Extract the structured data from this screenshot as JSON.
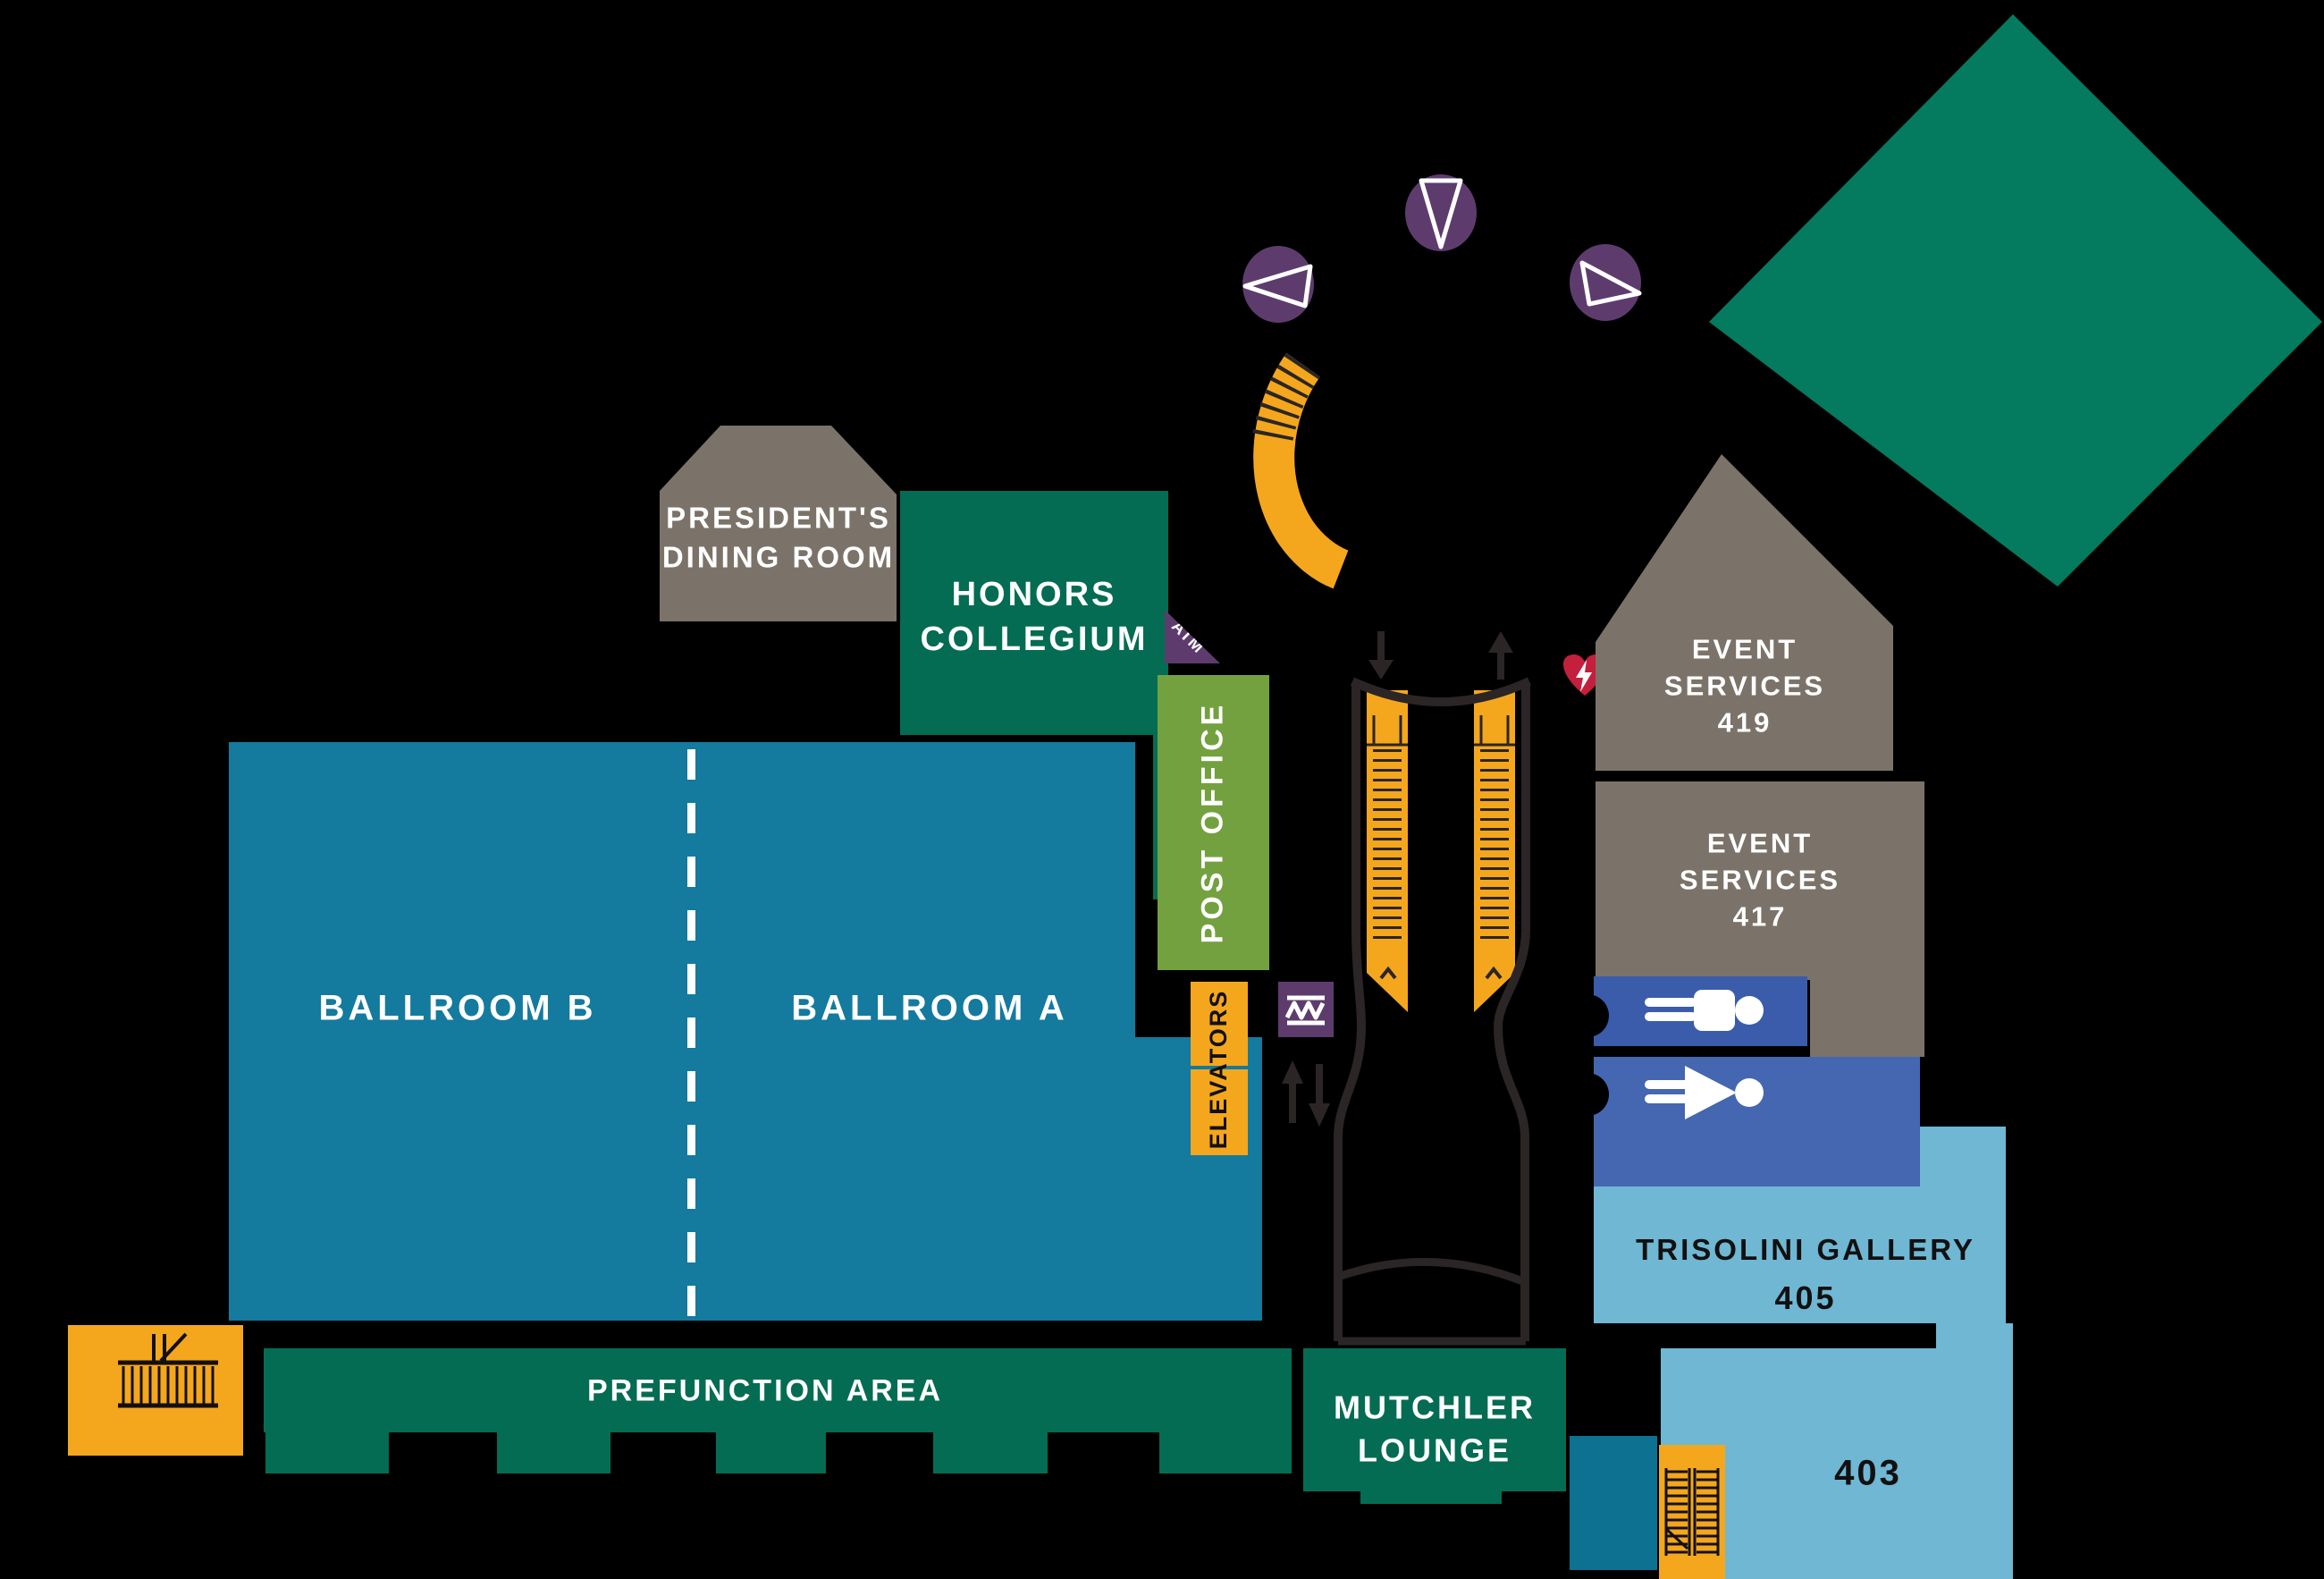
{
  "map_type": "building-floor-plan",
  "colors": {
    "background": "#000000",
    "room_dark_green": "#046c52",
    "diamond_green": "#047a5e",
    "ballroom_teal": "#147a9e",
    "dark_teal_block": "#0d7192",
    "room_gray": "#7b7369",
    "post_office_olive": "#74a13f",
    "gallery_light_blue": "#6fb7d3",
    "stairs_yellow": "#f4a71d",
    "marker_purple": "#5d3c6d",
    "restroom_blue_men": "#3a5cab",
    "restroom_blue_women": "#4566b0",
    "aed_red": "#c41f3c",
    "outline_charcoal": "#2b2526",
    "label_light": "#ffffff",
    "label_dark": "#131011"
  },
  "rooms": {
    "president_dining": {
      "line1": "PRESIDENT'S",
      "line2": "DINING ROOM"
    },
    "honors": {
      "line1": "HONORS",
      "line2": "COLLEGIUM"
    },
    "ballroom_b": {
      "label": "BALLROOM B"
    },
    "ballroom_a": {
      "label": "BALLROOM A"
    },
    "post_office": {
      "label": "POST OFFICE"
    },
    "atm": {
      "label": "ATM"
    },
    "elevators": {
      "label": "ELEVATORS"
    },
    "event_419": {
      "line1": "EVENT",
      "line2": "SERVICES",
      "line3": "419"
    },
    "event_417": {
      "line1": "EVENT",
      "line2": "SERVICES",
      "line3": "417"
    },
    "trisolini": {
      "line1": "TRISOLINI GALLERY",
      "line2": "405"
    },
    "room_403": {
      "label": "403"
    },
    "mutchler": {
      "line1": "MUTCHLER",
      "line2": "LOUNGE"
    },
    "prefunction": {
      "label": "PREFUNCTION AREA"
    }
  },
  "icons": {
    "direction_marker_left": "triangle-cone-pointing-left",
    "direction_marker_down": "triangle-cone-pointing-down",
    "direction_marker_right": "triangle-cone-pointing-right",
    "curved_stairs": "curved-staircase",
    "escalator_down_arrow": "down-arrow",
    "escalator_up_arrow": "up-arrow",
    "aed": "heart-with-lightning-bolt",
    "vending": "zigzag",
    "elevator_arrows": "up-and-down-arrows",
    "restroom_men": "man-figure-rotated",
    "restroom_women": "woman-figure-rotated",
    "stairs_west": "staircase",
    "stairs_403": "switchback-staircase",
    "rotunda_diamond": "rotated-square"
  }
}
